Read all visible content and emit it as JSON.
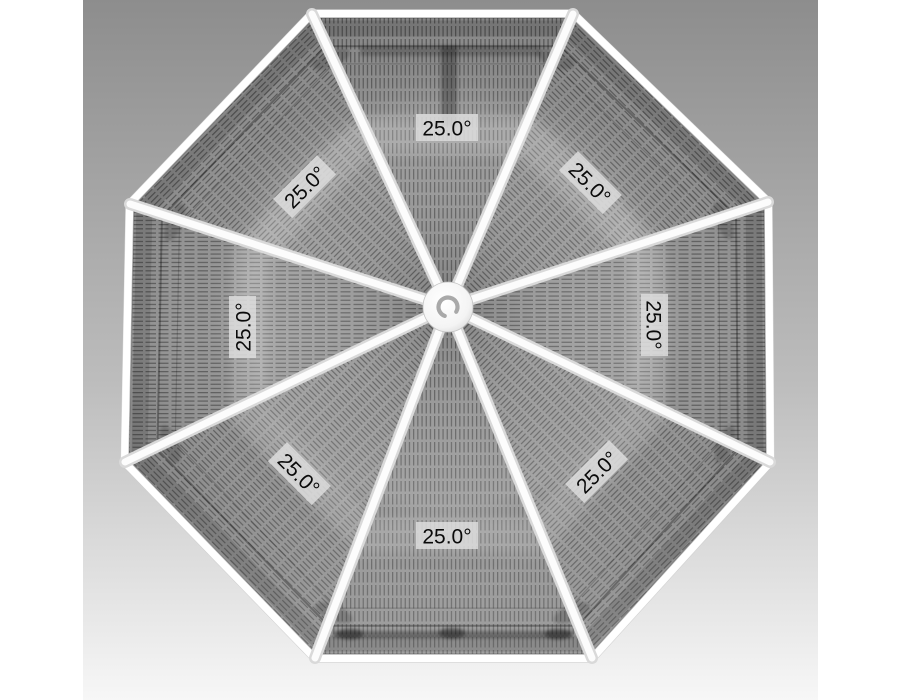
{
  "scene": {
    "type": "cad-roof-plan-render",
    "shape": "octagonal-roof-top-view"
  },
  "colors": {
    "margin": "#ffffff",
    "bg_top": "#8d8d8d",
    "bg_mid": "#bdbdbd",
    "bg_bottom": "#f7f7f7",
    "panel_base": "#9c9c9c",
    "hatch_line": "#3a3a3a",
    "fascia_white": "#ffffff",
    "fascia_band": "#e3e3e3",
    "fascia_hairline": "#bdbdbd",
    "ridge_outer": "#d9d9d9",
    "ridge_inner": "#fcfcfc",
    "hub_fill": "#fdfdfd",
    "hub_ring": "#a9a9a9",
    "label_bg": "#dcdcdc",
    "label_text": "#0a0a0a"
  },
  "geometry": {
    "canvas": {
      "x": 83,
      "y": 0,
      "w": 735,
      "h": 700
    },
    "center": {
      "x": 449,
      "y": 336
    },
    "hub": {
      "cx": 448,
      "cy": 307,
      "r": 25,
      "ring_r": 9.5,
      "ring_w": 4.2
    },
    "vertices": [
      [
        312,
        14
      ],
      [
        573,
        14
      ],
      [
        768,
        202
      ],
      [
        770,
        462
      ],
      [
        592,
        658
      ],
      [
        315,
        658
      ],
      [
        125,
        462
      ],
      [
        130,
        204
      ]
    ],
    "fascia": [
      {
        "s": 1.012,
        "w": 1.5,
        "c": "#bdbdbd"
      },
      {
        "s": 1.006,
        "w": 5,
        "c": "#e3e3e3"
      },
      {
        "s": 1.0,
        "w": 8,
        "c": "#ffffff"
      },
      {
        "s": 0.988,
        "w": 1.2,
        "c": "rgba(40,40,40,0.35)"
      }
    ],
    "rings": [
      {
        "s": 0.955,
        "w": 16,
        "c": "rgba(0,0,0,0.12)",
        "blur": false
      },
      {
        "s": 0.9,
        "w": 2,
        "c": "rgba(0,0,0,0.30)",
        "blur": false
      },
      {
        "s": 0.845,
        "w": 1.2,
        "c": "rgba(0,0,0,0.18)",
        "blur": false
      },
      {
        "s": 0.62,
        "w": 36,
        "c": "rgba(255,255,255,0.15)",
        "blur": true
      }
    ],
    "ridge": {
      "w_outer": 12,
      "w_inner": 7
    },
    "bracket_shadows": {
      "scale": 0.86,
      "rx": 20,
      "ry": 8,
      "opacity": 0.18
    },
    "details": {
      "top_bar": [
        360,
        46,
        180,
        10
      ],
      "top_post": [
        441,
        46,
        16,
        80
      ],
      "bottom_bar": [
        333,
        631,
        240,
        7
      ],
      "bottom_lumps": [
        [
          350,
          634
        ],
        [
          452,
          633
        ],
        [
          558,
          634
        ]
      ]
    }
  },
  "panels": [
    {
      "name": "top",
      "hatch": "hatchV",
      "label": {
        "text": "25.0°",
        "x": 447,
        "y": 128,
        "rot": 0
      }
    },
    {
      "name": "upper-right",
      "hatch": "hatchD2",
      "label": {
        "text": "25.0°",
        "x": 590,
        "y": 183,
        "rot": 45
      }
    },
    {
      "name": "right",
      "hatch": "hatchH",
      "label": {
        "text": "25.0°",
        "x": 654,
        "y": 325,
        "rot": 90
      }
    },
    {
      "name": "lower-right",
      "hatch": "hatchD1",
      "label": {
        "text": "25.0°",
        "x": 597,
        "y": 472,
        "rot": -45
      }
    },
    {
      "name": "bottom",
      "hatch": "hatchV",
      "label": {
        "text": "25.0°",
        "x": 447,
        "y": 536,
        "rot": 0
      }
    },
    {
      "name": "lower-left",
      "hatch": "hatchD2",
      "label": {
        "text": "25.0°",
        "x": 299,
        "y": 474,
        "rot": 45
      }
    },
    {
      "name": "left",
      "hatch": "hatchH",
      "label": {
        "text": "25.0°",
        "x": 243,
        "y": 327,
        "rot": -90
      }
    },
    {
      "name": "upper-left",
      "hatch": "hatchD1",
      "label": {
        "text": "25.0°",
        "x": 305,
        "y": 187,
        "rot": -45
      }
    }
  ]
}
